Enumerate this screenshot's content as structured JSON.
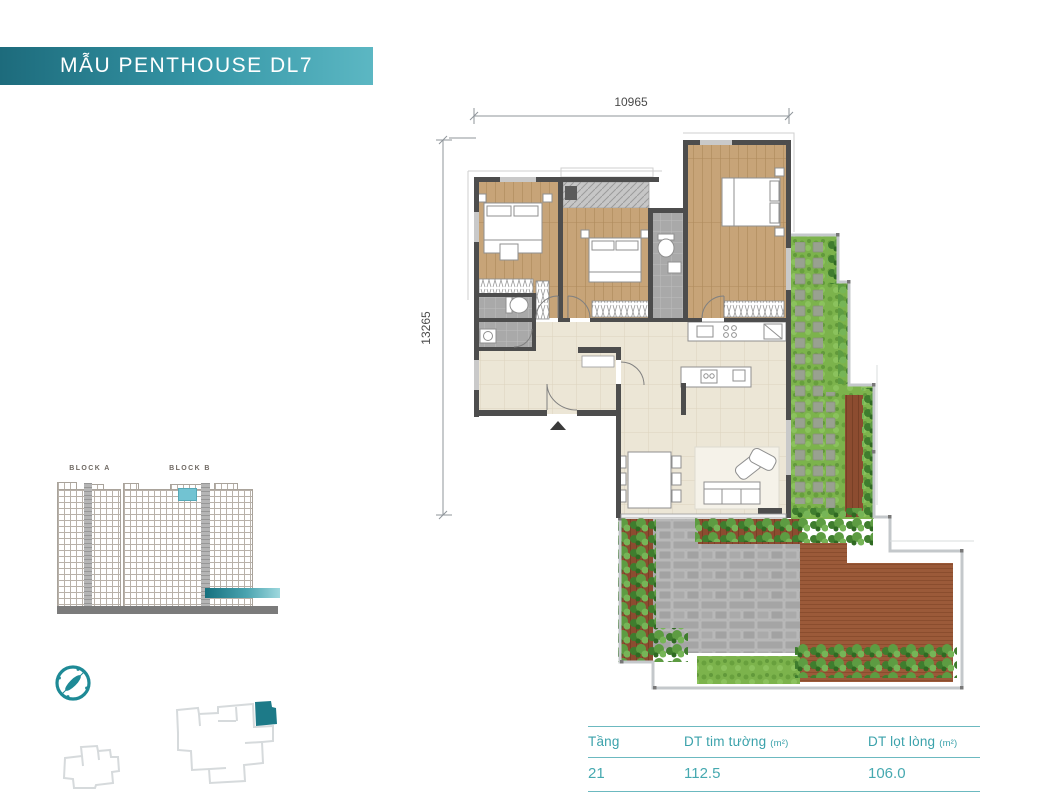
{
  "banner": {
    "title": "MẪU PENTHOUSE DL7"
  },
  "elevation": {
    "block_a_label": "BLOCK A",
    "block_b_label": "BLOCK B"
  },
  "plan": {
    "width_dim": "10965",
    "height_dim": "13265"
  },
  "legend_table": {
    "columns": [
      {
        "label": "Tầng",
        "unit": ""
      },
      {
        "label": "DT tim tường",
        "unit": "(m²)"
      },
      {
        "label": "DT lọt lòng",
        "unit": "(m²)"
      }
    ],
    "row": {
      "floor": "21",
      "gross": "112.5",
      "net": "106.0"
    }
  },
  "icons": {
    "compass": "compass-icon",
    "entry_arrow": "entry-arrow-icon"
  },
  "colors": {
    "accent_teal": "#2f9fa9",
    "banner_gradient_start": "#1d6b7c",
    "banner_gradient_end": "#5cb7c3",
    "highlight_cell": "#72c3d2",
    "unit_highlight": "#1d7a88",
    "wall": "#4d4d4d",
    "wood_floor": "#c7a478",
    "tile_floor": "#ece6d6",
    "grass": "#7cb34c",
    "deck_wood": "#9b5a39",
    "pavers": "#b2b2b2"
  }
}
